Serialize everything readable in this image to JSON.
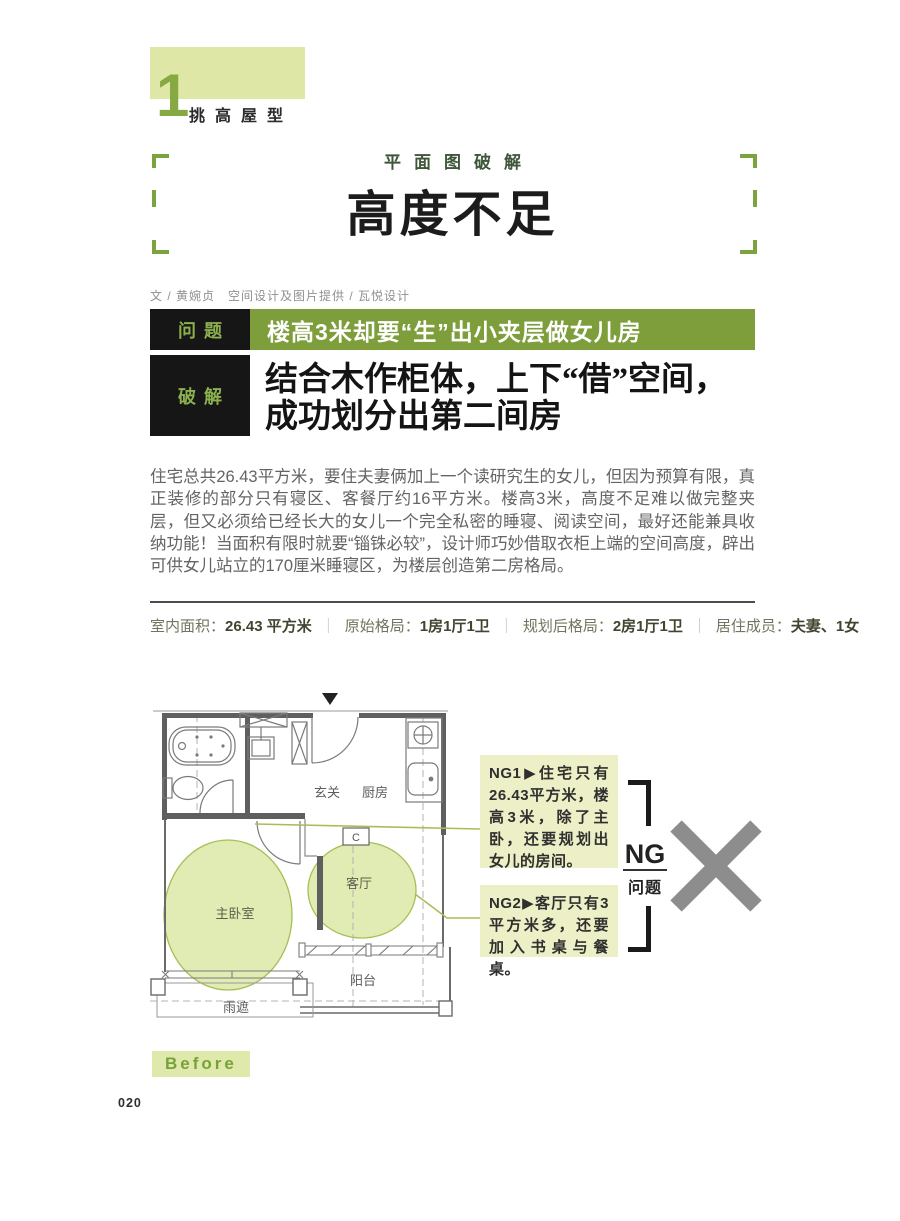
{
  "chapter": {
    "number": "1",
    "label": "挑高屋型"
  },
  "header": {
    "kicker": "平面图破解",
    "title": "高度不足",
    "credit": "文 / 黄婉贞　空间设计及图片提供 / 瓦悦设计"
  },
  "problem": {
    "tag": "问题",
    "text": "楼高3米却要“生”出小夹层做女儿房"
  },
  "solution": {
    "tag": "破解",
    "headline": "结合木作柜体，上下“借”空间，\n成功划分出第二间房"
  },
  "body": {
    "paragraph": "住宅总共26.43平方米，要住夫妻俩加上一个读研究生的女儿，但因为预算有限，真正装修的部分只有寝区、客餐厅约16平方米。楼高3米，高度不足难以做完整夹层，但又必须给已经长大的女儿一个完全私密的睡寝、阅读空间，最好还能兼具收纳功能！当面积有限时就要“锱铢必较”，设计师巧妙借取衣柜上端的空间高度，辟出可供女儿站立的170厘米睡寝区，为楼层创造第二房格局。"
  },
  "info": {
    "separator": "｜",
    "items": [
      {
        "label": "室内面积：",
        "value": "26.43 平方米"
      },
      {
        "label": "原始格局：",
        "value": "1房1厅1卫"
      },
      {
        "label": "规划后格局：",
        "value": "2房1厅1卫"
      },
      {
        "label": "居住成员：",
        "value": "夫妻、1女"
      }
    ]
  },
  "floorplan": {
    "rooms": {
      "entry": "玄关",
      "kitchen": "厨房",
      "living": "客厅",
      "master": "主卧室",
      "balcony": "阳台",
      "canopy": "雨遮"
    },
    "c_label": "C",
    "before_label": "Before"
  },
  "ng": {
    "big_label": "NG",
    "sub_label": "问题",
    "boxes": [
      {
        "text": "NG1▶住宅只有26.43平方米，楼高3米，除了主卧，还要规划出女儿的房间。"
      },
      {
        "text": "NG2▶客厅只有3平方米多，还要加入书桌与餐桌。"
      }
    ]
  },
  "page": {
    "number": "020"
  },
  "colors": {
    "accent_green": "#7d9e3b",
    "light_green_block": "#dfe7a6",
    "bracket_green": "#7ba33e",
    "tag_bg": "#161616",
    "tag_text": "#8cb04e",
    "ng_box_bg": "#edefc6",
    "overlay_green_fill": "#dbe6a3",
    "overlay_green_stroke": "#a6bf55",
    "cross_gray": "#8d8d8d"
  }
}
